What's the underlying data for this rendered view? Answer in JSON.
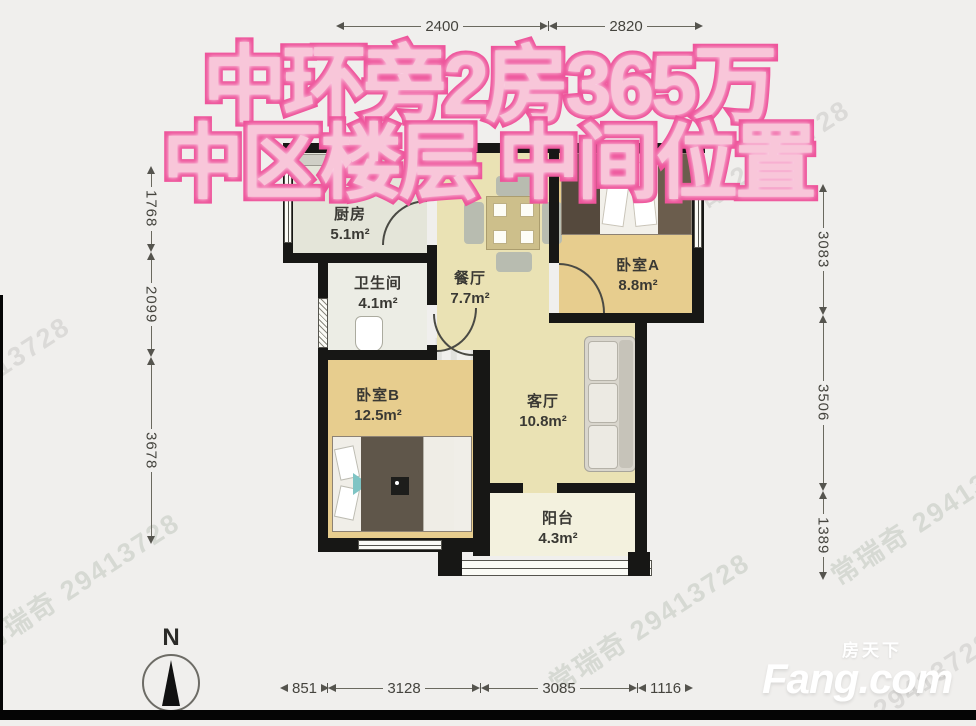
{
  "overlay": {
    "line1": "中环旁2房365万",
    "line2": "中区楼层 中间位置"
  },
  "floorplan": {
    "north_label": "N",
    "rooms": [
      {
        "name": "厨房",
        "area": "5.1m²"
      },
      {
        "name": "卫生间",
        "area": "4.1m²"
      },
      {
        "name": "餐厅",
        "area": "7.7m²"
      },
      {
        "name": "卧室A",
        "area": "8.8m²"
      },
      {
        "name": "客厅",
        "area": "10.8m²"
      },
      {
        "name": "卧室B",
        "area": "12.5m²"
      },
      {
        "name": "阳台",
        "area": "4.3m²"
      }
    ],
    "dimensions": {
      "top": [
        "2400",
        "2820"
      ],
      "left": [
        "1768",
        "2099",
        "3678"
      ],
      "right": [
        "3083",
        "3506",
        "1389"
      ],
      "bottom": [
        "851",
        "3128",
        "3085",
        "1116"
      ]
    }
  },
  "watermarks": {
    "agent": "常瑞奇 29413728",
    "number": "29413728",
    "lianjia": "Lianjia"
  },
  "branding": {
    "logo_cn": "房天下",
    "logo_en": "Fang.com"
  },
  "colors": {
    "overlay_fill": "#f8c6d9",
    "overlay_stroke": "#ee549b",
    "wall": "#171715",
    "wood_floor": "#e7cd8e",
    "hall_floor": "#eae2b4",
    "balcony_floor": "#f3f1de",
    "background": "#f0efed"
  }
}
